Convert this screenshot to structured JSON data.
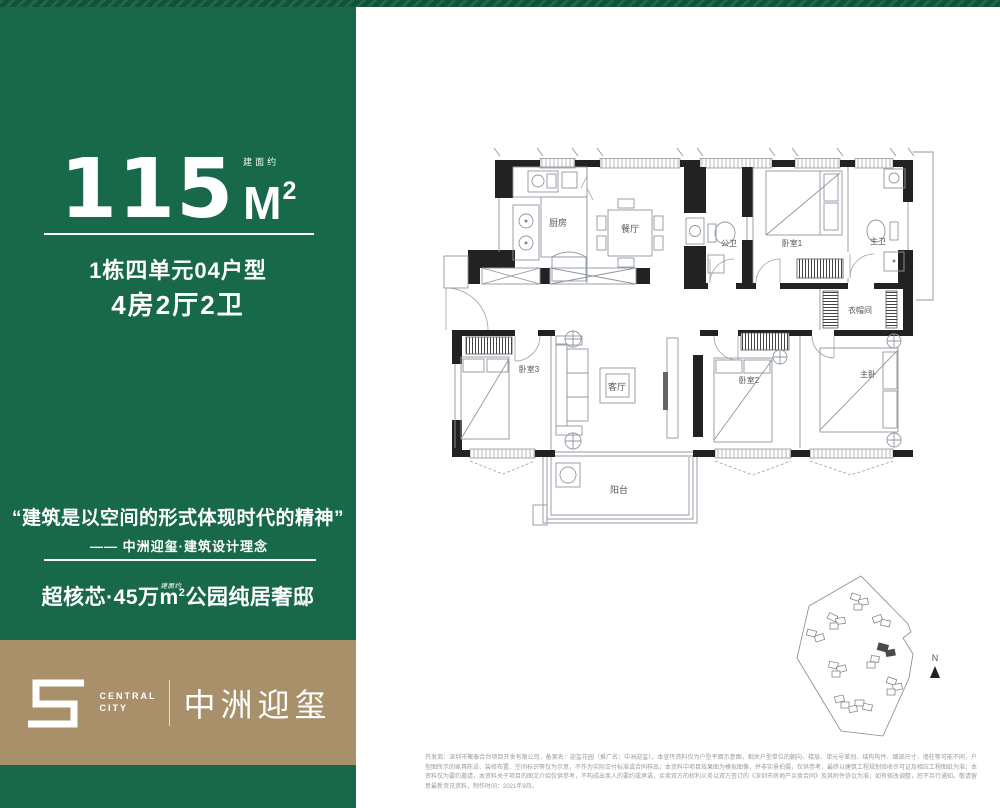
{
  "colors": {
    "green": "#17694a",
    "green_dark": "#0d5438",
    "gold": "#a8906a"
  },
  "left_panel": {
    "area_number": "115",
    "area_approx_label": "建面约",
    "area_unit": "M",
    "area_unit_sup": "2",
    "unit_type_line": "1栋四单元04户型",
    "rooms_line": "4房2厅2卫",
    "quote": "“建筑是以空间的形式体现时代的精神”",
    "quote_source": "—— 中洲迎玺·建筑设计理念",
    "slogan_head": "超核芯·45万",
    "slogan_area_approx": "建面约",
    "slogan_unit": "m",
    "slogan_unit_sup": "2",
    "slogan_tail": "公园纯居奢邸"
  },
  "logo": {
    "en_line1": "CENTRAL",
    "en_line2": "CITY",
    "cn": "中洲迎玺"
  },
  "floorplan": {
    "rooms": {
      "kitchen": "厨房",
      "dining": "餐厅",
      "public_bath": "公卫",
      "bedroom1": "卧室1",
      "master_bath": "主卫",
      "cloakroom": "衣帽间",
      "bedroom3": "卧室3",
      "living": "客厅",
      "bedroom2": "卧室2",
      "master_bedroom": "主卧",
      "balcony": "阳台"
    }
  },
  "site_plan": {
    "compass": "N"
  },
  "disclaimer": "开发商：深圳市聚泰合台项目开发有限公司，备案名：迎玺花园（推广名：中洲迎玺），本宣传资料仅为户型平面示意图，相关户型单位的朝向、楼层、单元号差别、结构构件、细部尺寸、墙柱等可能不同，户型图所示的家具陈设、装修布置、空间标识等仅为示意，不作为实际交付标准或合同样品；本资料中项目效果图为模拟图像，并非实景拍摄，仅供参考，最终以建筑工程规划验收许可证及相应工程图纸为准；本资料仅为要约邀请，本资料关于项目的图文介绍仅供参考，不构成出卖人的要约或承诺，买卖双方的权利义务以双方签订的《深圳市房地产买卖合同》及其附件协议为准；如有修改调整，恕不另行通知。敬请留意最新资讯资料，制作时间：2021年9月。"
}
